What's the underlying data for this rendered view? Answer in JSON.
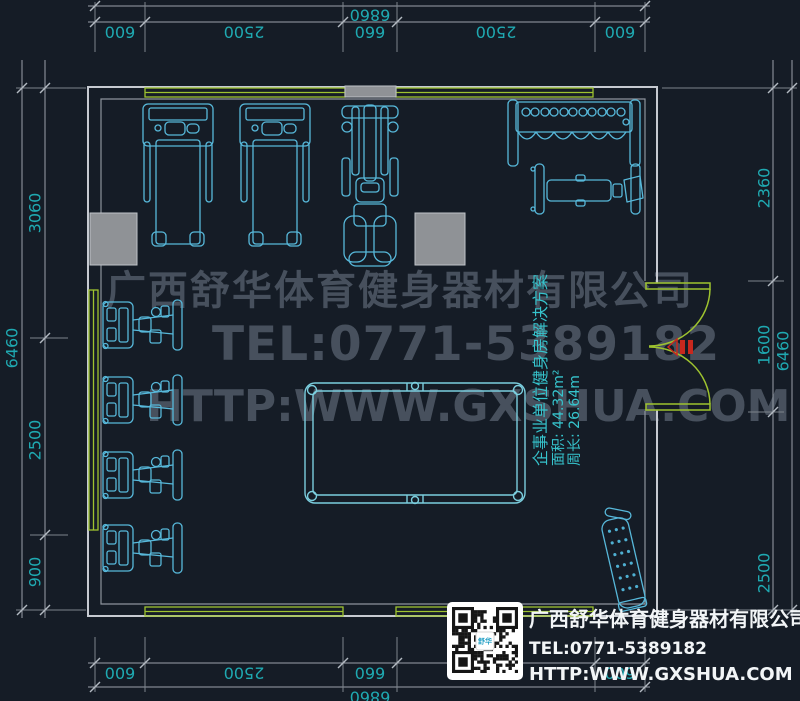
{
  "dims": {
    "top_total": "6860",
    "top_chain": [
      "600",
      "2500",
      "660",
      "2500",
      "600"
    ],
    "bottom_total": "6860",
    "bottom_chain": [
      "600",
      "2500",
      "660",
      "2500",
      "600"
    ],
    "left_total": "6460",
    "left_chain": [
      "3060",
      "2500",
      "900"
    ],
    "right_total": "6460",
    "right_chain": [
      "2360",
      "1600",
      "2500"
    ]
  },
  "watermark": {
    "company": "广西舒华体育健身器材有限公司",
    "tel": "TEL:0771-5389182",
    "website": "HTTP:WWW.GXSHUA.COM"
  },
  "plan_label": {
    "title": "企事业单位健身房解决方案",
    "area": "面积: 44.32m²",
    "perimeter": "周长: 26.64m"
  },
  "contact_card": {
    "company": "广西舒华体育健身器材有限公司",
    "tel": "TEL:0771-5389182",
    "website": "HTTP:WWW.GXSHUA.COM",
    "qr_logo": "舒华"
  },
  "equipment": [
    "treadmill",
    "treadmill",
    "multi-station-gym",
    "dumbbell-rack",
    "weight-bench",
    "strength-machine",
    "strength-machine",
    "strength-machine",
    "strength-machine",
    "billiard-table",
    "situp-board",
    "entrance-double-door"
  ],
  "colors": {
    "background": "#151c26",
    "equipment_line": "#57b8da",
    "window_door": "#9ec32f",
    "dimension_text": "#1fa9b1",
    "wall": "#c6cad1",
    "door_marker": "#c8281e"
  }
}
